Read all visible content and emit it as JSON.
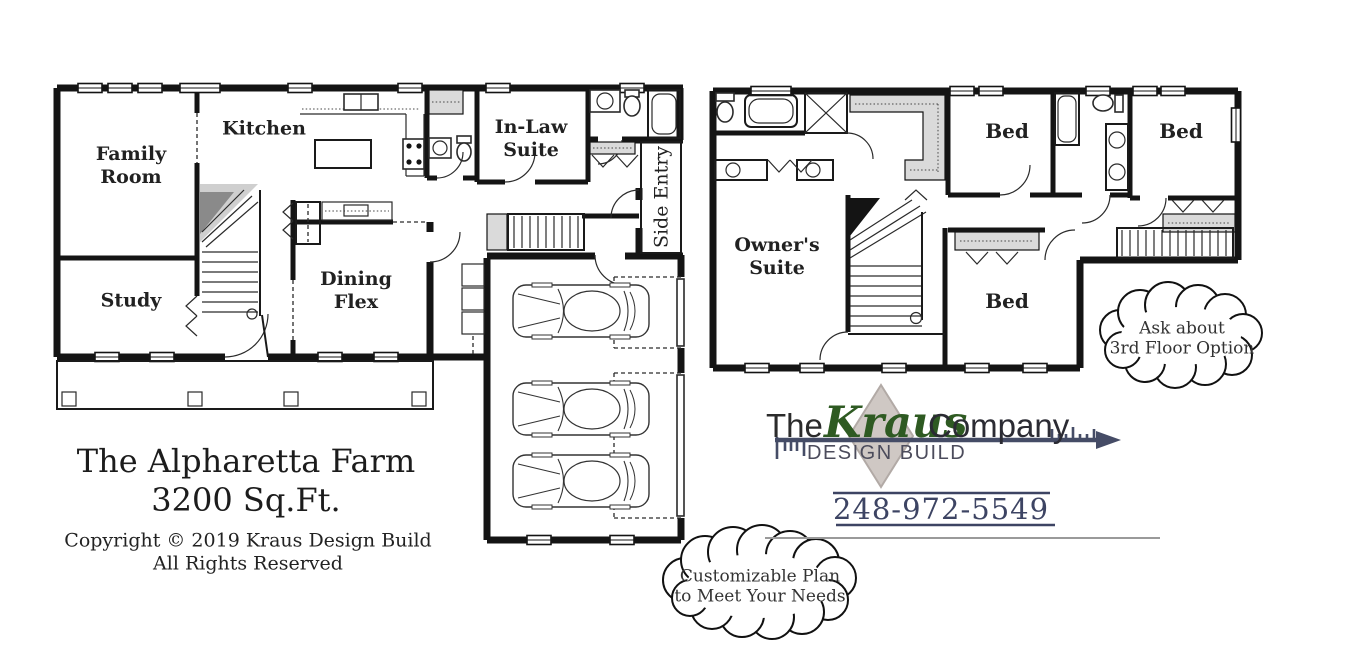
{
  "colors": {
    "wall": "#141414",
    "closet_shade": "#dadada",
    "stair_dark": "#8a8a8a",
    "stair_light": "#cfcfcf",
    "kraus_green": "#2e5a22",
    "logo_navy": "#454c66",
    "phone_navy": "#3d4463",
    "design_build_gray": "#4c4c5c",
    "diamond_fill": "#cfc8c4",
    "diamond_border": "#b2aaa6",
    "background": "#ffffff"
  },
  "first_floor": {
    "rooms": {
      "family_room": "Family\nRoom",
      "study": "Study",
      "kitchen": "Kitchen",
      "dining_flex": "Dining\nFlex",
      "in_law_suite": "In-Law\nSuite",
      "side_entry": "Side Entry"
    }
  },
  "second_floor": {
    "rooms": {
      "owners_suite": "Owner's\nSuite",
      "bed_top_left": "Bed",
      "bed_top_right": "Bed",
      "bed_bottom": "Bed"
    }
  },
  "callouts": {
    "third_floor": "Ask about\n3rd Floor Option",
    "customizable": "Customizable Plan\nto Meet Your Needs"
  },
  "title_block": {
    "plan_name": "The Alpharetta Farm",
    "area": "3200 Sq.Ft.",
    "copyright_line1": "Copyright © 2019 Kraus Design Build",
    "copyright_line2": "All Rights Reserved"
  },
  "logo": {
    "prefix": "The",
    "name": "Kraus",
    "suffix": "Company",
    "tagline": "DESIGN BUILD",
    "phone": "248-972-5549"
  },
  "icons": {
    "fixtures": [
      "toilet-icon",
      "sink-icon",
      "bathtub-icon",
      "shower-icon",
      "range-icon",
      "stairs-icon",
      "car-icon",
      "window-icon",
      "door-swing-icon",
      "closet-bifold-icon",
      "porch-post-icon",
      "tape-measure-arrow-icon",
      "cloud-bubble"
    ]
  }
}
